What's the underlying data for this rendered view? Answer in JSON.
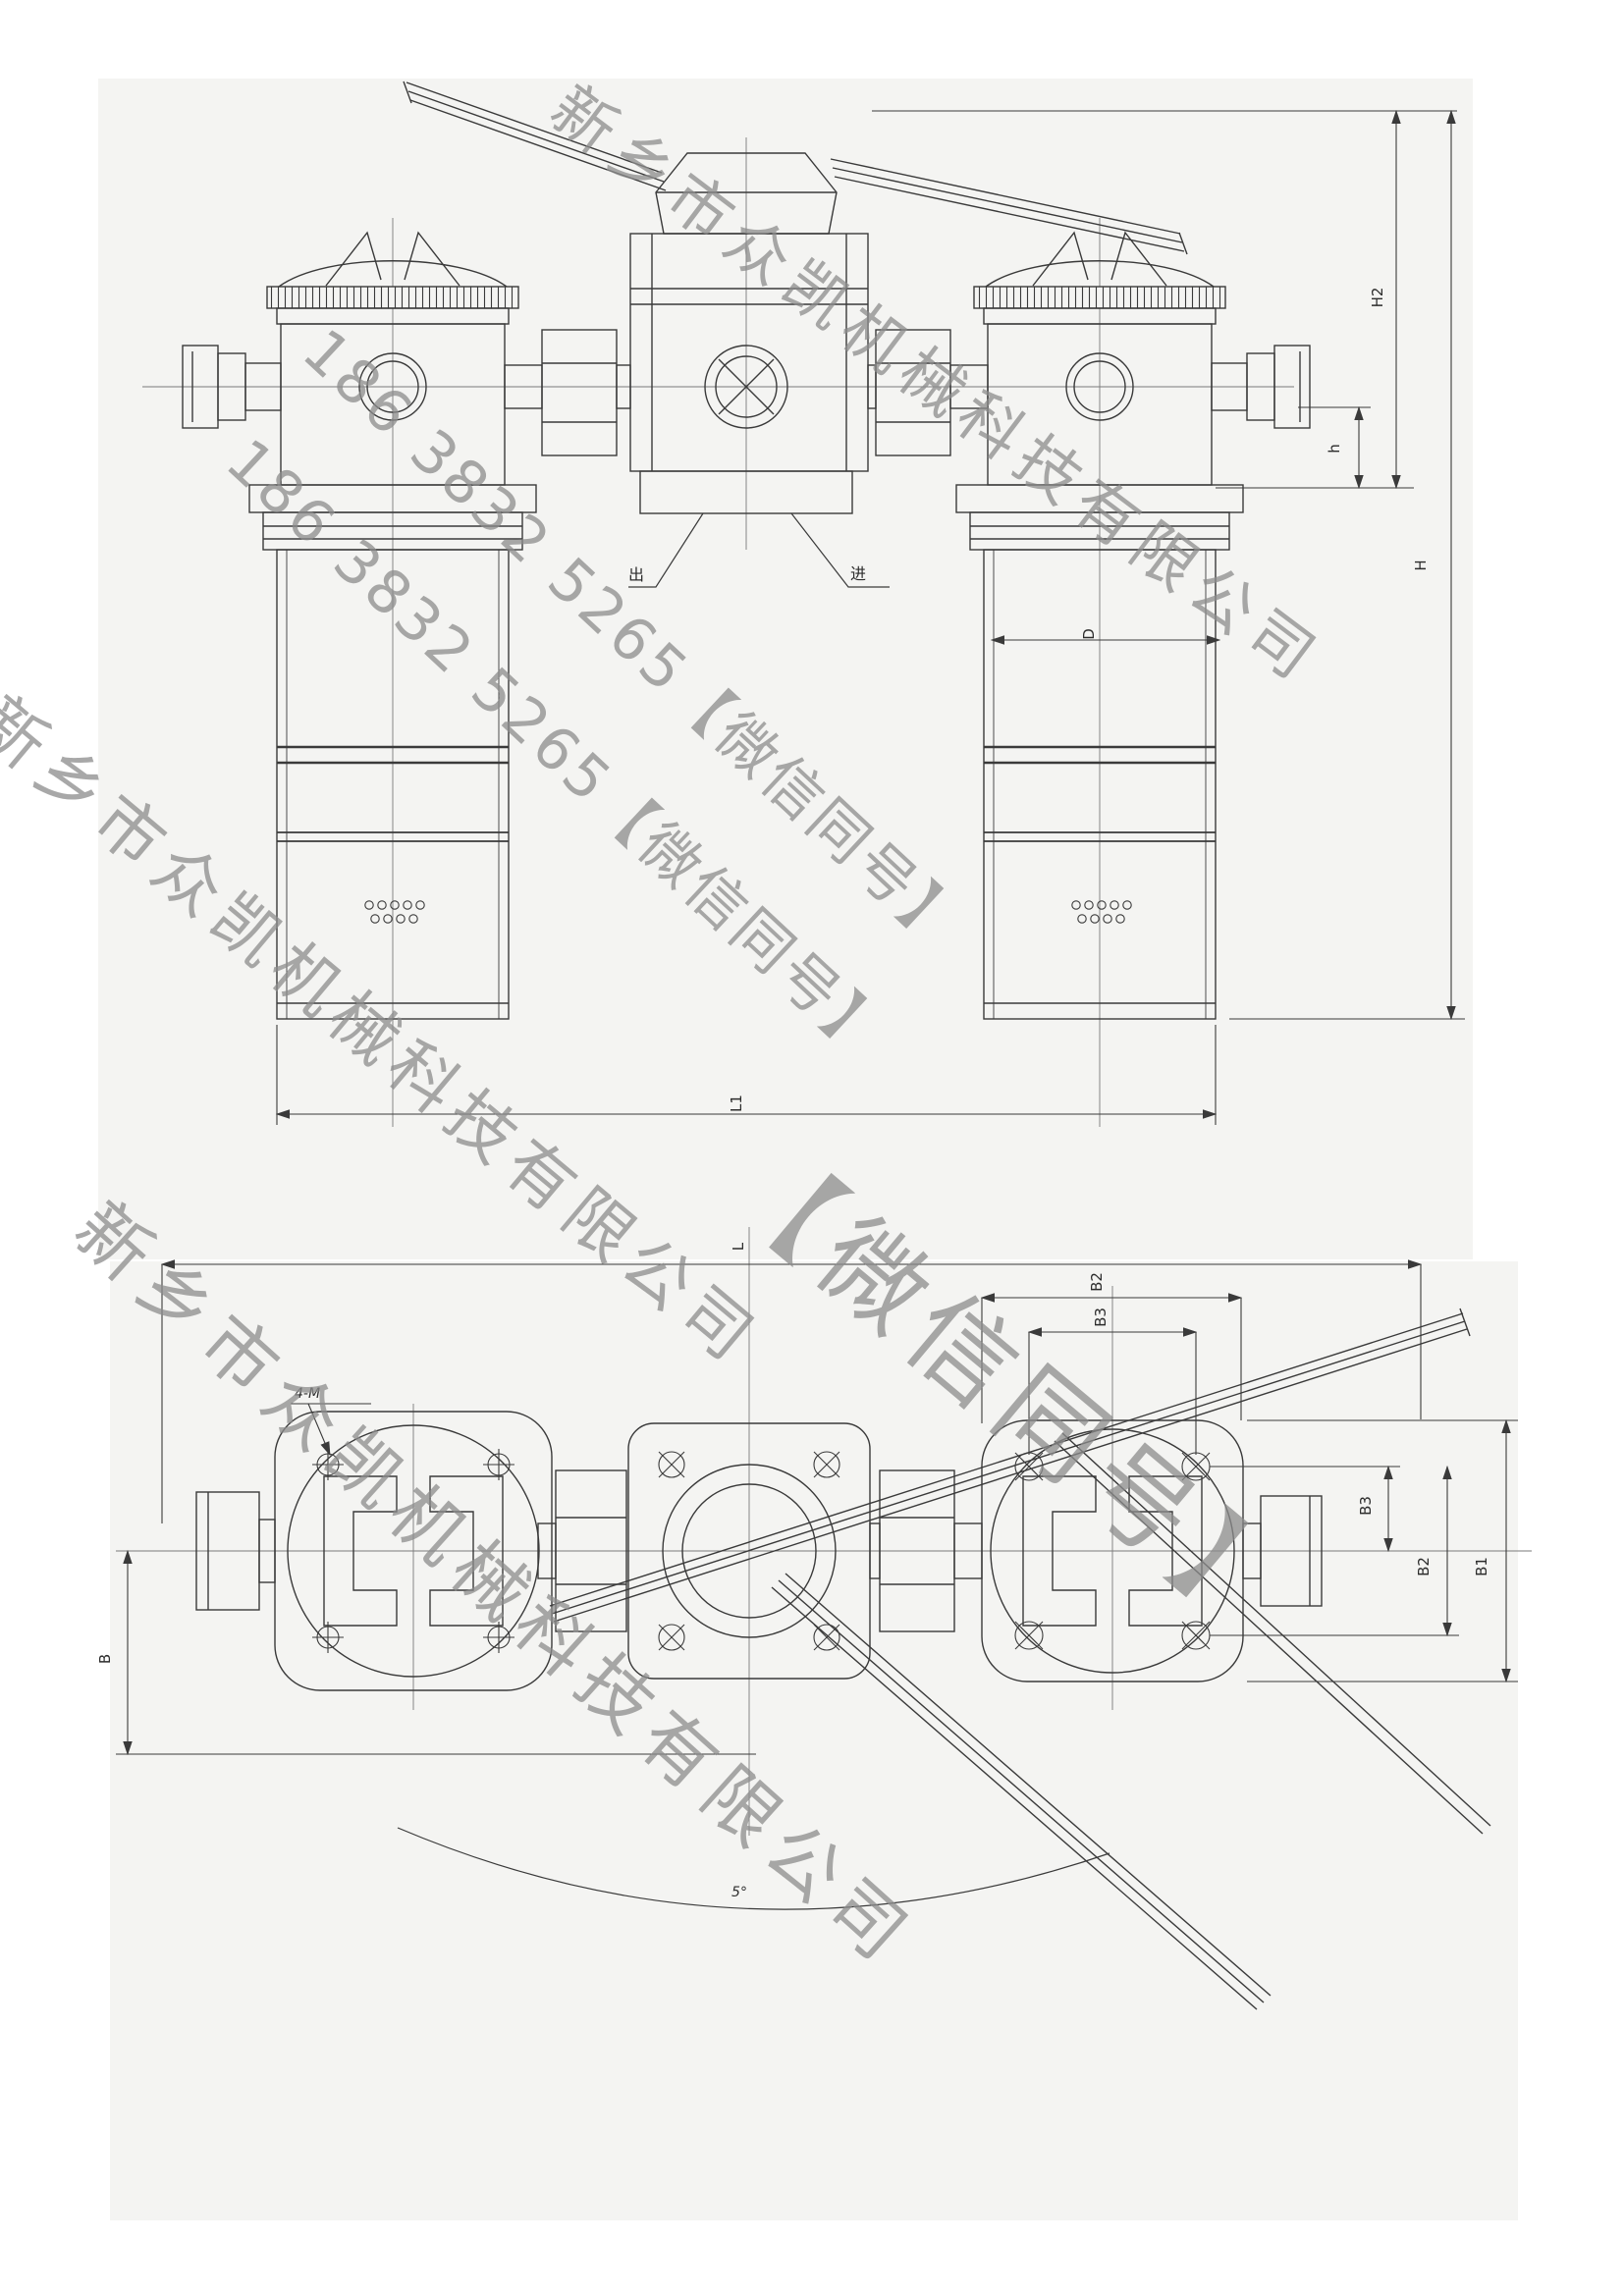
{
  "watermarks": {
    "company": "新乡市众凯机械科技有限公司",
    "phone": "186 3832 5265【微信同号】",
    "wechat": "【微信同号】",
    "color": "#8c8c8c"
  },
  "front_view": {
    "dim_h2": "H2",
    "dim_h_small": "h",
    "dim_h_total": "H",
    "dim_d": "D",
    "dim_l1": "L1",
    "port_out": "出",
    "port_in": "进"
  },
  "plan_view": {
    "dim_l": "L",
    "dim_b": "B",
    "dim_b1": "B1",
    "dim_b2": "B2",
    "dim_b3": "B3",
    "dim_b2_top": "B2",
    "dim_b3_top": "B3",
    "mount_holes": "4-M",
    "swing_angle": "5°"
  }
}
